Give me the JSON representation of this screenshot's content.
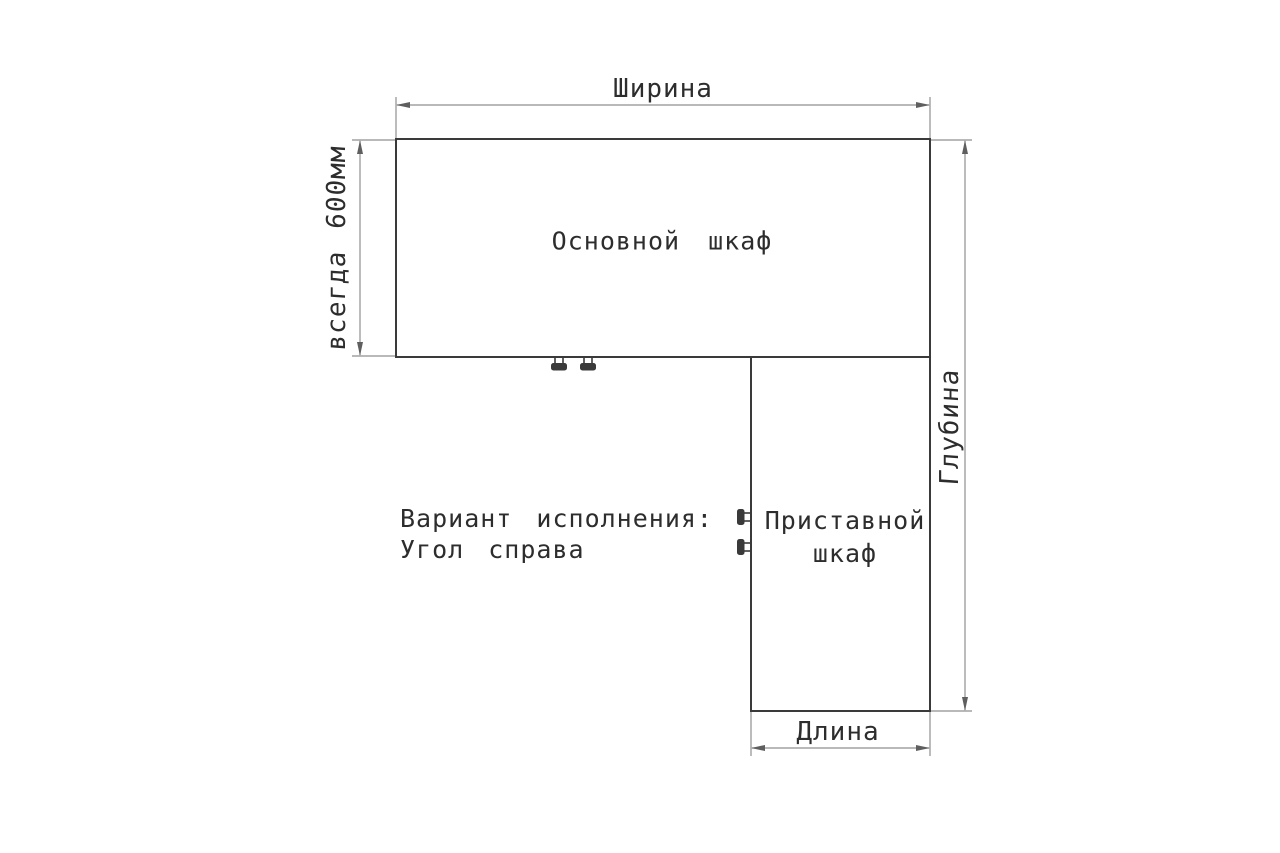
{
  "diagram": {
    "labels": {
      "width": "Ширина",
      "always_600": "всегда 600мм",
      "depth": "Глубина",
      "length": "Длина",
      "main_cabinet": "Основной шкаф",
      "attached_cabinet_line1": "Приставной",
      "attached_cabinet_line2": "шкаф",
      "variant_line1": "Вариант исполнения:",
      "variant_line2": "Угол справа"
    },
    "icons": {
      "connector": "cam-lock-connector-icon"
    },
    "colors": {
      "background": "#ffffff",
      "outline": "#3a3a3a",
      "dimension": "#8f8f8f",
      "arrowhead": "#5f5f5f",
      "text": "#2d2d2d"
    }
  }
}
